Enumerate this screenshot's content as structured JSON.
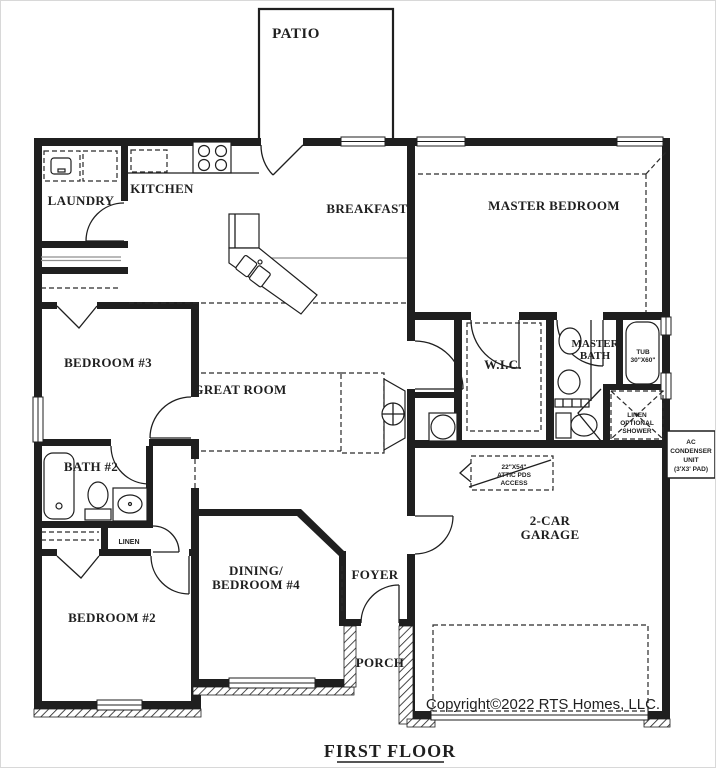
{
  "plan": {
    "sheet_title": "FIRST FLOOR",
    "copyright": "Copyright©2022 RTS Homes, LLC."
  },
  "rooms": {
    "patio": "PATIO",
    "laundry": "LAUNDRY",
    "kitchen": "KITCHEN",
    "breakfast": "BREAKFAST",
    "master_bedroom": "MASTER BEDROOM",
    "bedroom3": "BEDROOM #3",
    "great_room": "GREAT ROOM",
    "wic": "W.I.C.",
    "master_bath_1": "MASTER",
    "master_bath_2": "BATH",
    "bath2": "BATH #2",
    "bedroom2": "BEDROOM #2",
    "dining_1": "DINING/",
    "dining_2": "BEDROOM #4",
    "foyer": "FOYER",
    "porch": "PORCH",
    "garage_1": "2-CAR",
    "garage_2": "GARAGE"
  },
  "annotations": {
    "linen": "LINEN",
    "tub_1": "TUB",
    "tub_2": "30\"X60\"",
    "attic_1": "22\"X54\"",
    "attic_2": "ATTIC PDS",
    "attic_3": "ACCESS",
    "shower_1": "LINEN",
    "shower_2": "OPTIONAL",
    "shower_3": "SHOWER",
    "ac_1": "AC",
    "ac_2": "CONDENSER",
    "ac_3": "UNIT",
    "ac_4": "(3'X3' PAD)"
  },
  "colors": {
    "line": "#1f1f1f",
    "gray_line": "#8f8f8f",
    "copyright_text": "#4f4f4f",
    "background": "#ffffff"
  }
}
